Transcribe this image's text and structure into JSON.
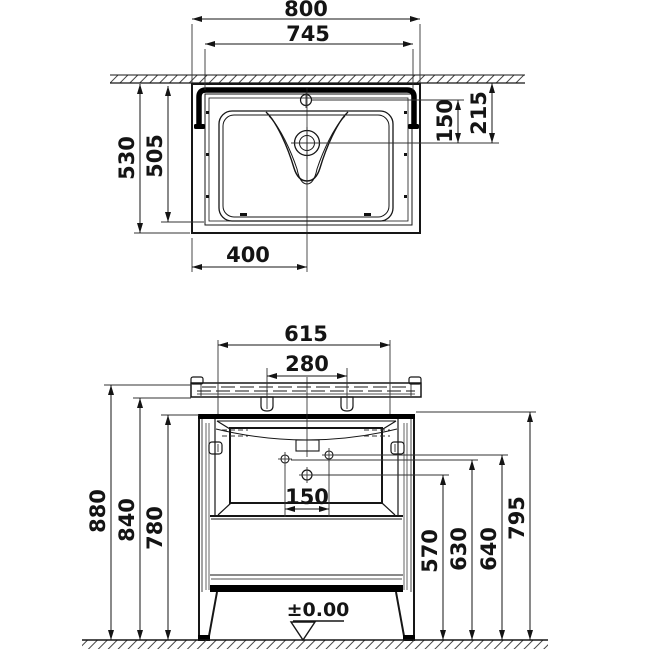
{
  "drawing": {
    "type": "washbasin-vanity-unit-technical-drawing",
    "line_color": "#161616",
    "bg_color": "#ffffff",
    "top_view": {
      "overall_width": "800",
      "inner_width": "745",
      "overall_depth": "530",
      "inner_depth": "505",
      "faucet_to_drain": "150",
      "wall_to_drain": "215",
      "drain_center_offset": "400"
    },
    "front_view": {
      "mount_width": "615",
      "lug_spacing": "280",
      "total_height": "880",
      "basin_bottom_height": "840",
      "cabinet_height": "780",
      "hole_spacing": "150",
      "center_hole_height": "570",
      "left_hole_height": "630",
      "right_hole_height": "640",
      "cabinet_top_height": "795",
      "floor_level": "±0.00"
    }
  }
}
